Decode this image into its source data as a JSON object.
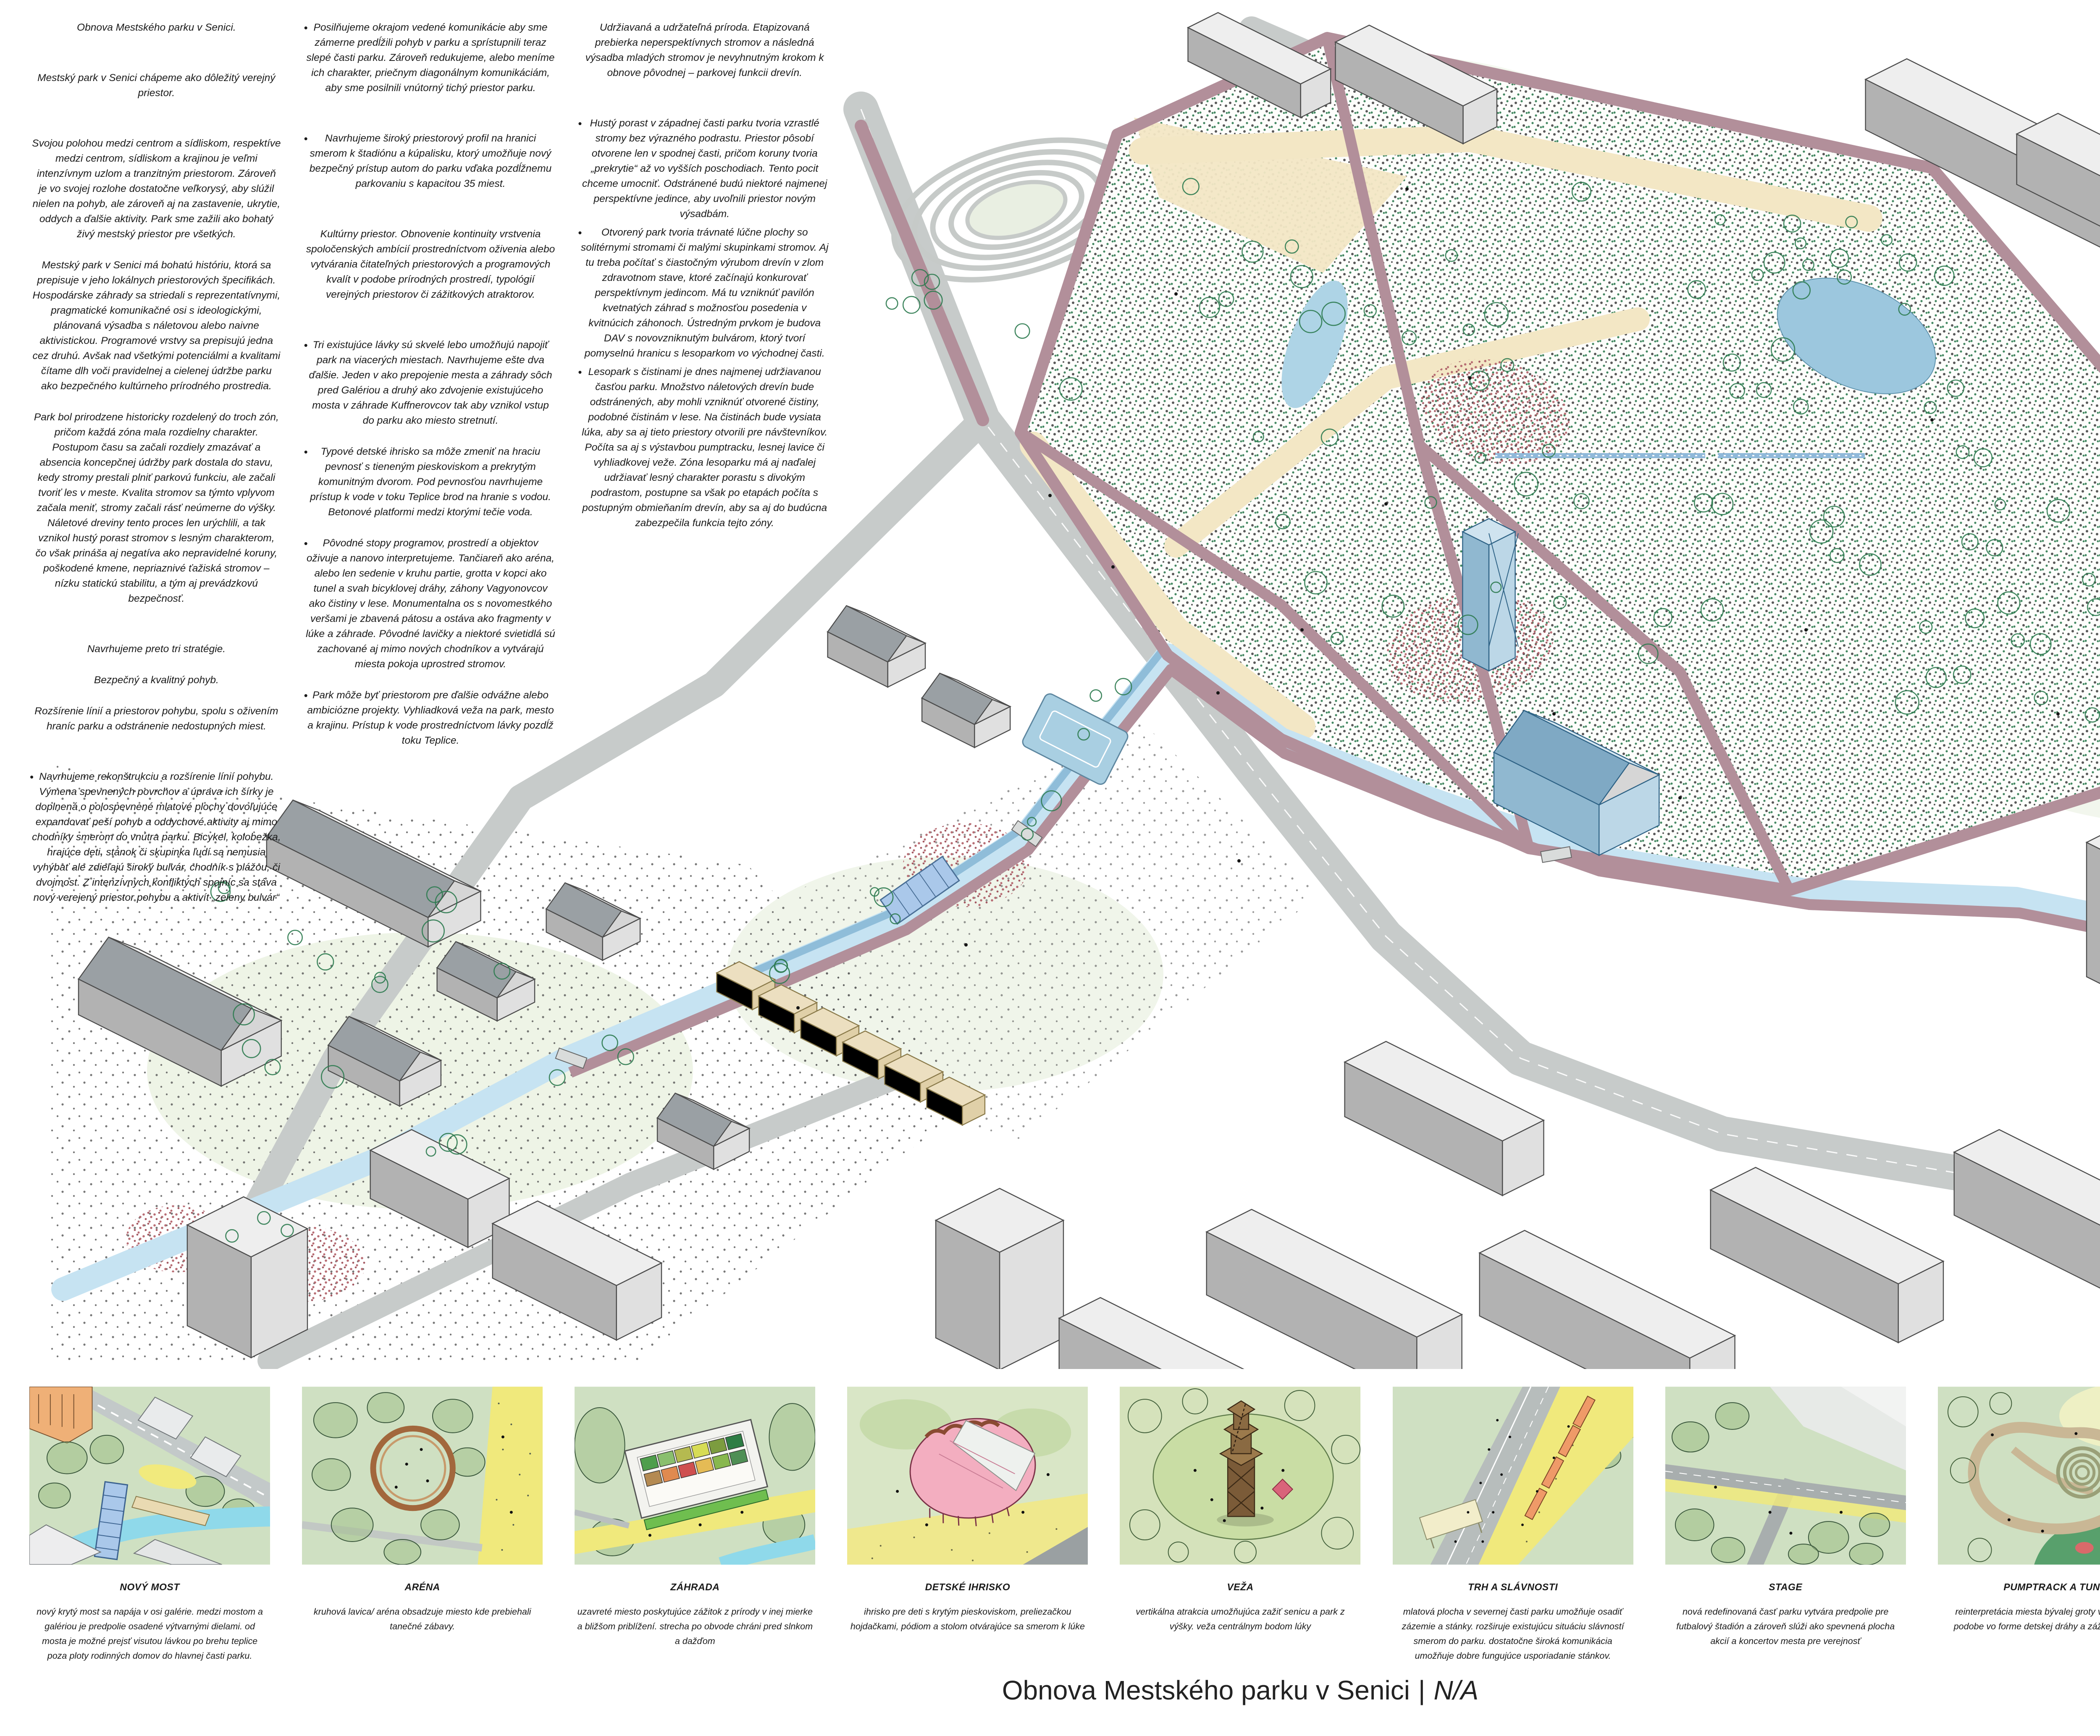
{
  "labels": {
    "axonometria": "AXONOMETRIA"
  },
  "footer": {
    "title": "Obnova Mestského parku v Senici",
    "separator": "|",
    "suffix": "N/A"
  },
  "columns": [
    {
      "paragraphs": [
        {
          "text": "Obnova Mestského parku v Senici."
        },
        {
          "text": "Mestský park v Senici chápeme ako dôležitý verejný priestor."
        },
        {
          "text": "Svojou polohou medzi centrom a sídliskom, respektíve medzi centrom, sídliskom a krajinou je veľmi intenzívnym uzlom a tranzitným priestorom. Zároveň je vo svojej rozlohe dostatočne veľkorysý, aby slúžil nielen na pohyb, ale zároveň aj na zastavenie, ukrytie, oddych a ďalšie aktivity. Park sme zažili ako bohatý živý mestský priestor pre všetkých."
        },
        {
          "text": "Mestský park v Senici má bohatú históriu, ktorá sa prepisuje v jeho lokálnych priestorových špecifikách. Hospodárske záhrady sa striedali s reprezentatívnymi, pragmatické komunikačné osi s ideologickými, plánovaná výsadba s náletovou alebo naivne aktivistickou. Programové vrstvy sa prepisujú jedna cez druhú. Avšak nad všetkými potenciálmi a kvalitami čítame dlh voči pravidelnej a cielenej údržbe parku ako bezpečného kultúrneho prírodného prostredia."
        },
        {
          "text": "Park bol prirodzene historicky rozdelený do troch zón, pričom každá zóna mala rozdielny charakter. Postupom času sa začali rozdiely zmazávať a absencia koncepčnej údržby park dostala do stavu, kedy stromy prestali plniť parkovú funkciu, ale začali tvoriť les v meste. Kvalita stromov sa týmto vplyvom začala meniť, stromy začali rásť neúmerne do výšky. Náletové dreviny tento proces len urýchlili, a tak vznikol hustý porast stromov s lesným charakterom, čo však prináša aj negatíva ako nepravidelné koruny, poškodené kmene, nepriaznivé ťažiská stromov – nízku statickú stabilitu, a tým aj prevádzkovú bezpečnosť."
        },
        {
          "text": "Navrhujeme preto tri stratégie."
        },
        {
          "text": "Bezpečný a kvalitný pohyb."
        },
        {
          "text": "Rozšírenie línií a priestorov pohybu, spolu s oživením hraníc parku a odstránenie nedostupných miest."
        },
        {
          "text": "Navrhujeme rekonštrukciu a rozšírenie línií pohybu. Výmena spevnených povrchov a úprava ich šírky je doplnená o polospevnené mlatové plochy dovoľujúce expandovať peší pohyb a oddychové aktivity aj mimo chodníky smerom do vnútra parku. Bicykel, kolobežka, hrajúce deti, stánok či skupinka ľudí sa nemusia vyhýbať ale zdieľajú široký bulvár, chodník s plážou, či dvojmost. Z intenzívnych konfliktých spojníc sa stáva nový verejený priestor pohybu a aktivít „zeleny bulvár“"
        }
      ]
    },
    {
      "paragraphs": [
        {
          "text": "Posilňujeme okrajom vedené komunikácie aby sme zámerne predĺžili pohyb v parku a sprístupnili teraz slepé časti parku. Zároveň redukujeme, alebo meníme ich charakter, priečnym diagonálnym komunikáciám, aby sme posilnili vnútorný tichý priestor parku."
        },
        {
          "text": "Navrhujeme široký priestorový profil na hranici smerom k štadiónu a kúpalisku, ktorý umožňuje nový bezpečný prístup autom do parku vďaka pozdĺžnemu parkovaniu s kapacitou 35 miest."
        },
        {
          "text": "Kultúrny priestor.  Obnovenie kontinuity vrstvenia spoločenských ambícií prostredníctvom oživenia alebo vytvárania čitateľných priestorových a programových kvalít v podobe prírodných prostredí, typológií verejných priestorov či zážitkových atraktorov."
        },
        {
          "text": "Tri existujúce lávky sú skvelé lebo umožňujú napojiť park na viacerých miestach. Navrhujeme ešte dva ďalšie. Jeden v ako prepojenie mesta a záhrady sôch pred Galériou a druhý ako zdvojenie existujúceho mosta v záhrade Kuffnerovcov tak aby vznikol vstup do parku ako miesto stretnutí."
        },
        {
          "text": "Typové detské ihrisko sa môže zmeniť na hraciu pevnosť s tieneným pieskoviskom a prekrytým komunitným dvorom. Pod pevnosťou navrhujeme prístup k vode v toku Teplice brod na hranie s vodou. Betonové platformi medzi ktorými tečie voda."
        },
        {
          "text": "Pôvodné stopy programov, prostredí a objektov oživuje a nanovo interpretujeme. Tančiareň ako aréna, alebo len sedenie v kruhu partie, grotta v kopci ako tunel a svah bicyklovej dráhy, záhony Vagyonovcov ako čistiny v lese. Monumentalna os s novomestkého veršami je zbavená pátosu a ostáva ako fragmenty v lúke a záhrade. Pôvodné lavičky a niektoré svietidlá sú zachované aj mimo nových chodníkov a vytvárajú miesta pokoja uprostred stromov."
        },
        {
          "text": "Park môže byť priestorom pre ďalšie odvážne alebo ambiciózne projekty. Vyhliadková veža na park, mesto a krajinu. Prístup k vode prostredníctvom lávky pozdĺž toku Teplice."
        }
      ]
    },
    {
      "paragraphs": [
        {
          "text": "Udržiavaná a udržateľná príroda. Etapizovaná prebierka neperspektívnych stromov a následná výsadba mladých stromov je nevyhnutným krokom k obnove pôvodnej – parkovej funkcii drevín."
        },
        {
          "text": "Hustý porast v západnej časti parku tvoria vzrastlé stromy bez výrazného podrastu. Priestor pôsobí otvorene len v spodnej časti, pričom koruny tvoria „prekrytie“ až vo vyšších poschodiach. Tento pocit chceme umocniť. Odstránené budú niektoré najmenej perspektívne jedince, aby uvoľnili priestor novým výsadbám."
        },
        {
          "text": "Otvorený park tvoria trávnaté lúčne plochy so solitérnymi stromami či malými skupinkami stromov. Aj tu treba počítať s čiastočným výrubom drevín v zlom zdravotnom stave, ktoré začínajú konkurovať perspektívnym jedincom. Má tu vzniknúť pavilón kvetnatých záhrad s možnosťou posedenia v kvitnúcich záhonoch.  Ústredným prvkom je budova DAV s novovzniknutým bulvárom, ktorý tvorí pomyselnú hranicu s lesoparkom vo východnej časti."
        },
        {
          "text": "Lesopark s čistinami je dnes najmenej udržiavanou časťou parku. Množstvo náletových drevín bude odstránených, aby mohli vzniknúť otvorené čistiny, podobné čistinám v lese. Na čistinách bude vysiata lúka, aby sa aj tieto priestory otvorili pre návštevníkov. Počíta sa aj s výstavbou pumptracku, lesnej lavice či vyhliadkovej veže. Zóna lesoparku má aj naďalej udržiavať lesný charakter porastu s divokým podrastom, postupne sa však po etapách počíta s postupným obmieňaním drevín, aby sa aj do budúcna zabezpečila funkcia tejto zóny."
        }
      ]
    }
  ],
  "thumbs": [
    {
      "title": "NOVÝ MOST",
      "text": "nový krytý most sa napája v osi galérie. medzi mostom a galériou je predpolie osadené výtvarnými dielami. od mosta je možné prejsť visutou lávkou po brehu teplice poza ploty rodinných domov do hlavnej časti parku."
    },
    {
      "title": "ARÉNA",
      "text": "kruhová lavica/ aréna obsadzuje miesto kde prebiehali tanečné zábavy."
    },
    {
      "title": "ZÁHRADA",
      "text": "uzavreté miesto poskytujúce zážitok z prírody v inej mierke a bližšom priblížení. strecha po obvode chráni pred slnkom a dažďom"
    },
    {
      "title": "DETSKÉ IHRISKO",
      "text": "ihrisko pre deti s krytým pieskoviskom, preliezačkou hojdačkami, pódiom a stolom otvárajúce sa smerom k lúke"
    },
    {
      "title": "VEŽA",
      "text": "vertikálna atrakcia umožňujúca zažiť senicu a park z výšky. veža centrálnym bodom lúky"
    },
    {
      "title": "TRH A SLÁVNOSTI",
      "text": "mlatová plocha v severnej časti parku umožňuje osadiť zázemie a stánky. rozširuje existujúcu situáciu slávností smerom do parku. dostatočne široká komunikácia umožňuje dobre fungujúce usporiadanie stánkov."
    },
    {
      "title": "STAGE",
      "text": "nová redefinovaná časť parku vytvára predpolie pre futbalový štadión a zároveň slúži ako spevnená plocha akcií a koncertov mesta pre verejnosť"
    },
    {
      "title": "PUMPTRACK A TUNEL",
      "text": "reinterpretácia miesta bývalej groty v neromantickej podobe vo forme detskej dráhy a zážitkového tunela"
    },
    {
      "title": "VENČOVISKO/ VÝBEH",
      "text": "roh parku pri kňupalisku tvorí rozšírená oplotená mlatová plocha parku slúžiaca ako výbeh pre psy"
    }
  ]
}
